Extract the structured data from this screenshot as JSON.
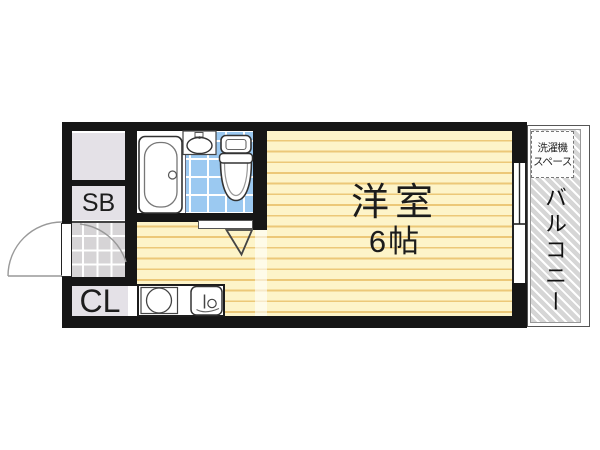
{
  "plan_type": "apartment-floor-plan",
  "rooms": {
    "main_room": {
      "label": "洋室",
      "size": "6帖"
    },
    "shoe_box": {
      "label": "SB"
    },
    "closet": {
      "label": "CL"
    },
    "balcony": {
      "label": "バルコニー"
    },
    "laundry_space": {
      "line1": "洗濯機",
      "line2": "スペース"
    }
  },
  "colors": {
    "wall": "#161616",
    "room_floor": "#fdf4c9",
    "floor_stripe": "#ecc878",
    "bath_tile": "#9bc9f1",
    "storage_gray": "#e4e1e7",
    "genkan_tile": "#d6d4d6",
    "balcony_hatch": "#d6d6d6"
  }
}
